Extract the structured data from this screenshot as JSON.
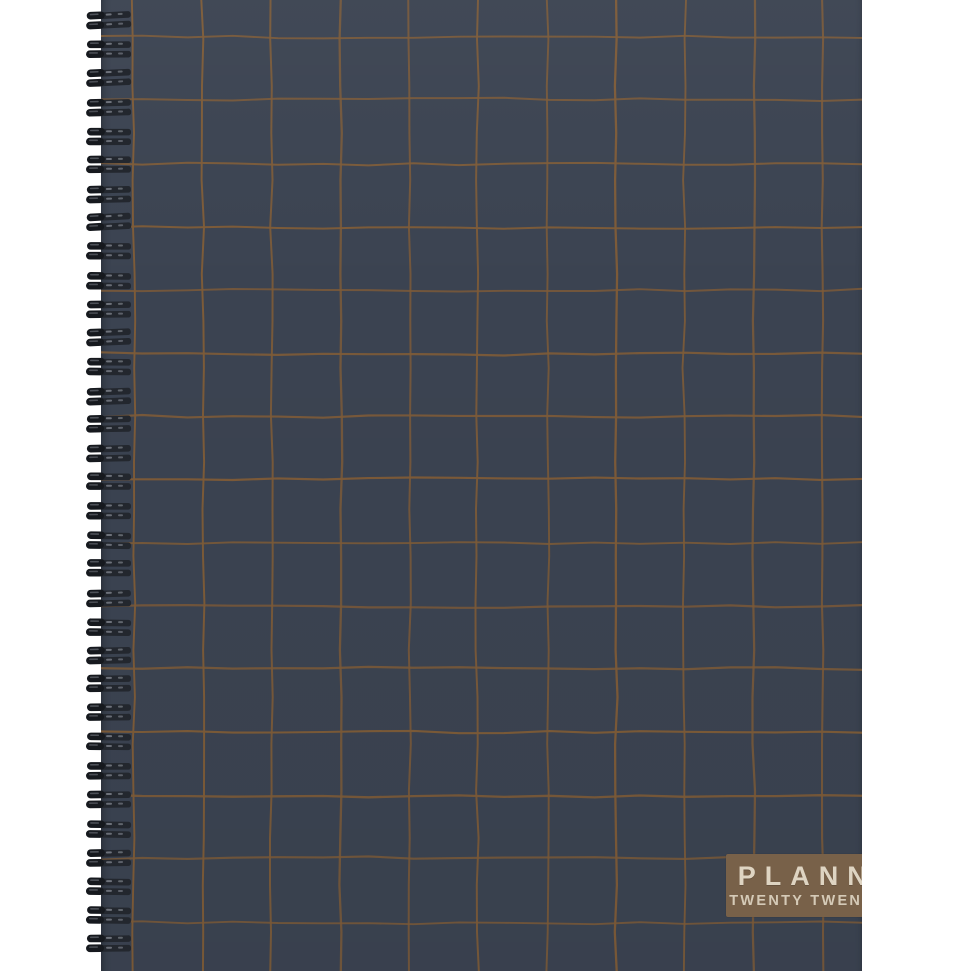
{
  "product": {
    "type": "spiral-bound planner notebook photo",
    "cover": {
      "title": "PLANNER",
      "subtitle": "TWENTY TWENTY-FIVE",
      "pattern": {
        "style": "hand-drawn grid",
        "columns": 11,
        "rows": 15
      }
    },
    "binding": {
      "style": "twin-loop wire coils",
      "coil_count": 33,
      "side": "left"
    }
  },
  "colors": {
    "background": "#ffffff",
    "cover": "#3b4351",
    "grid_line": "#7d5b38",
    "label_background": "#786149",
    "title_text": "#ded4c2",
    "subtitle_text": "#d5cab7",
    "coil_dark": "#16191e",
    "coil_mid": "#23272e",
    "coil_highlight": "#7b8088"
  }
}
